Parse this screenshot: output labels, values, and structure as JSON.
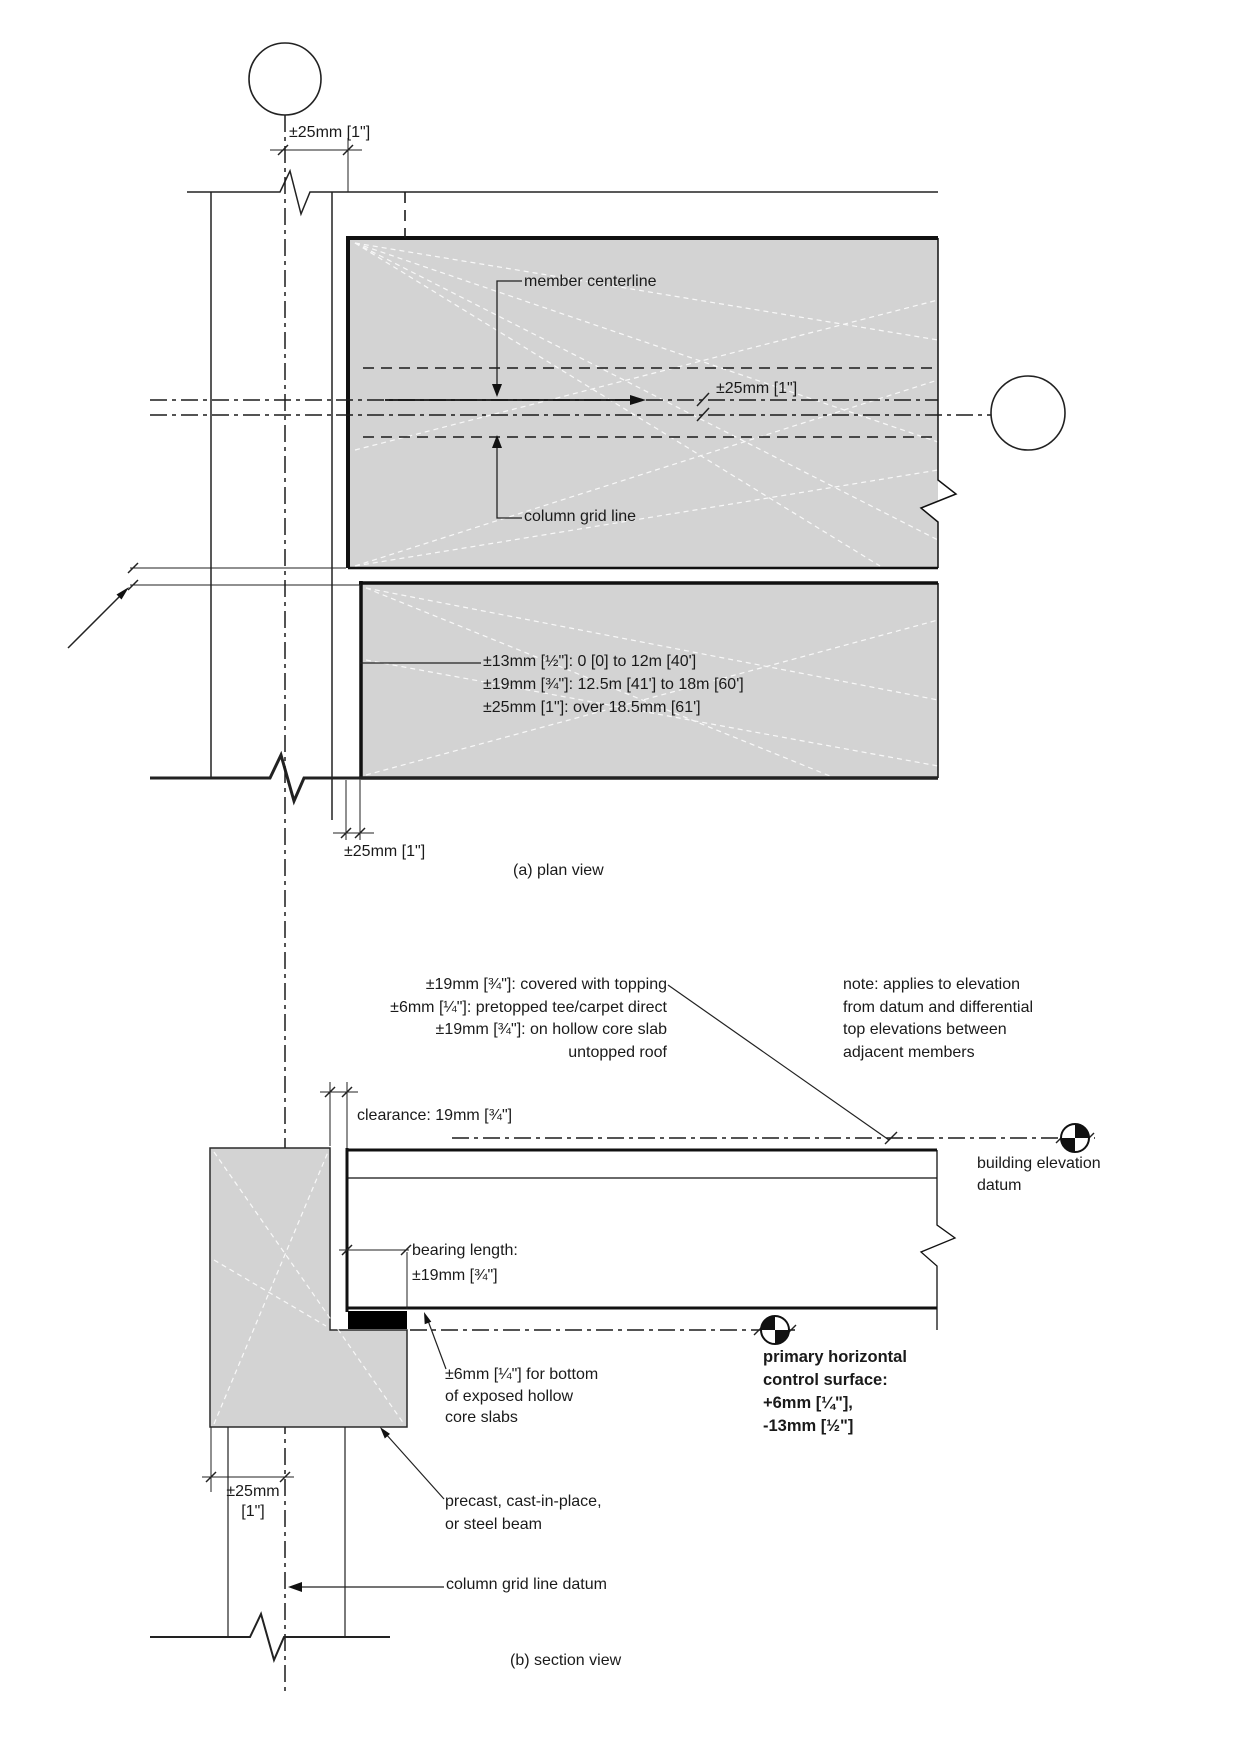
{
  "plan": {
    "caption": "(a) plan view",
    "dim_top": "±25mm [1\"]",
    "member_centerline": "member centerline",
    "dim_center": "±25mm [1\"]",
    "column_grid_line": "column grid line",
    "tolerance_lines": [
      "±13mm [½\"]: 0 [0] to 12m [40']",
      "±19mm [¾\"]: 12.5m [41'] to 18m [60']",
      "±25mm [1\"]: over 18.5mm [61']"
    ],
    "dim_bottom": "±25mm [1\"]"
  },
  "section": {
    "caption": "(b) section view",
    "topping_lines": [
      "±19mm [¾\"]: covered with topping",
      "±6mm [¼\"]: pretopped tee/carpet direct",
      "±19mm [¾\"]: on hollow core slab",
      "untopped roof"
    ],
    "note_lines": [
      "note: applies to elevation",
      "from datum and differential",
      "top elevations between",
      "adjacent members"
    ],
    "clearance": "clearance: 19mm [¾\"]",
    "building_datum": [
      "building elevation",
      "datum"
    ],
    "bearing": [
      "bearing length:",
      "±19mm [¾\"]"
    ],
    "bottom_tolerance": [
      "±6mm [¼\"] for bottom",
      "of exposed hollow",
      "core slabs"
    ],
    "primary_control": [
      "primary horizontal",
      "control surface:",
      "+6mm [¼\"],",
      "-13mm [½\"]"
    ],
    "dim_left": [
      "±25mm",
      "[1\"]"
    ],
    "beam_label": [
      "precast, cast-in-place,",
      "or steel beam"
    ],
    "grid_datum": "column grid line datum"
  },
  "colors": {
    "line": "#1b1b1b",
    "member_fill": "#d3d3d3",
    "pad_fill": "#000000"
  }
}
